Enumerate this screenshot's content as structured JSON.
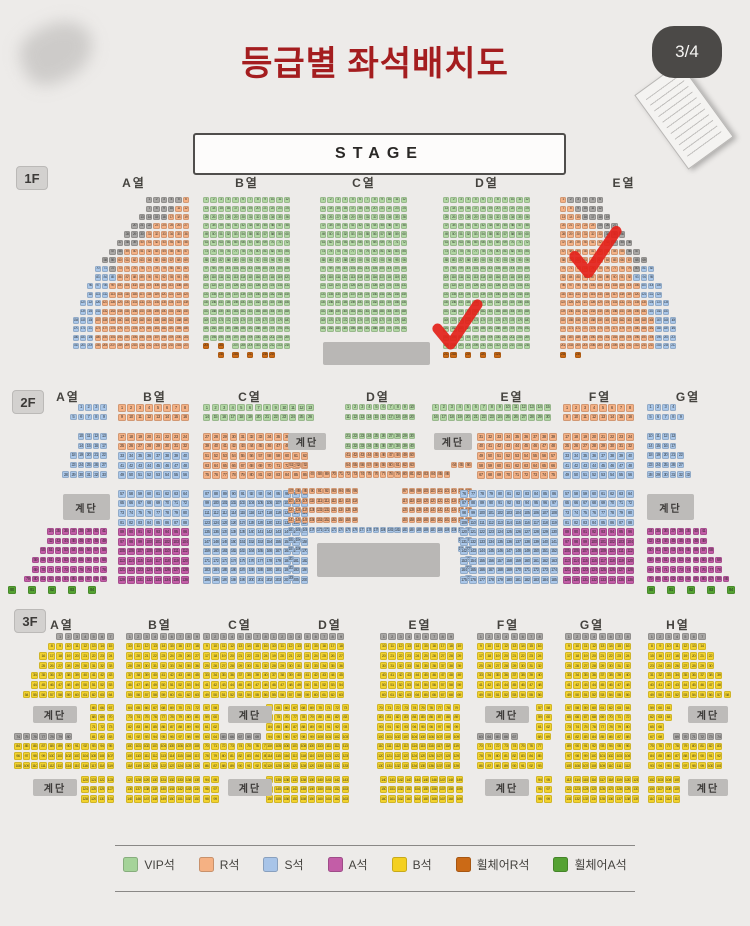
{
  "page": {
    "title": "등급별 좌석배치도",
    "page_indicator": "3/4"
  },
  "stage": {
    "label": "STAGE"
  },
  "stairs_label": "계단",
  "checkmark_color": "#e3221b",
  "seat_colors": {
    "G": "#b2d7a4",
    "R": "#f5b286",
    "S": "#aac7e9",
    "A": "#c35da7",
    "B": "#f3d32e",
    "W": "#cb6a16",
    "V": "#55a233",
    "X": "#a9a7a5"
  },
  "legend": {
    "items": [
      {
        "label": "VIP석",
        "color": "#a5d399"
      },
      {
        "label": "R석",
        "color": "#f5b183"
      },
      {
        "label": "S석",
        "color": "#a8c4e8"
      },
      {
        "label": "A석",
        "color": "#c35da7"
      },
      {
        "label": "B석",
        "color": "#f4d020"
      },
      {
        "label": "휠체어R석",
        "color": "#cb6a16"
      },
      {
        "label": "휠체어A석",
        "color": "#55a233"
      }
    ]
  },
  "floors": [
    {
      "id": "1F",
      "px": 7.35,
      "py": 8.6,
      "s": 6.3,
      "fs": 3.6,
      "badge": {
        "label": "1F",
        "x": 16,
        "y": 166
      },
      "labels": [
        {
          "text": "A열",
          "x": 134,
          "y": 174
        },
        {
          "text": "B열",
          "x": 247,
          "y": 174
        },
        {
          "text": "C열",
          "x": 364,
          "y": 174
        },
        {
          "text": "D열",
          "x": 487,
          "y": 174
        },
        {
          "text": "E열",
          "x": 624,
          "y": 174
        }
      ],
      "blocks": [
        {
          "section": "A",
          "x": 190,
          "y": 197,
          "align": "right",
          "rows": [
            "XXXXXR",
            "XXXXRR",
            "XXXXRRR",
            "XXXRRRRR",
            "XXXRRRRRR",
            "XXXRRRRRRR",
            "XXRRRRRRRRR",
            "XXRRRRRRRRRR",
            "SSXRRRRRRRRRR",
            "SSSRRRRRRRRRR",
            "SSSRRRRRRRRRRR",
            "SSSRRRRRRRRRRR",
            "SSSRRRRRRRRRRRR",
            "SSSRRRRRRRRRRRR",
            [
              4,
              "SSSRRRRRRRRRRRRR"
            ]
          ]
        },
        {
          "section": "B",
          "x": 203,
          "y": 197,
          "rows": [
            [
              17,
              "GGGGGGGGGGGG"
            ],
            "W.W.GGGGGGGG",
            "..W.W.W.WW"
          ]
        },
        {
          "section": "C",
          "x": 320,
          "y": 197,
          "rows": [
            [
              16,
              "GGGGGGGGGGGG"
            ]
          ]
        },
        {
          "section": "D",
          "x": 443,
          "y": 197,
          "rows": [
            [
              18,
              "GGGGGGGGGGGG"
            ],
            "WW.W.W.W"
          ]
        },
        {
          "section": "E",
          "x": 560,
          "y": 197,
          "rows": [
            "RXXXXX",
            "RRXXXX",
            "RRRXXXX",
            "RRRRRXXX",
            "RRRRRRXXX",
            "RRRRRRRXXX",
            "RRRRRRRRRXX",
            "RRRRRRRRRRXX",
            "RRRRRRRRRRXSS",
            "RRRRRRRRRRSSS",
            "RRRRRRRRRRRSSS",
            "RRRRRRRRRRRSSS",
            "RRRRRRRRRRRRSSS",
            "RRRRRRRRRRRRSSS",
            [
              4,
              "RRRRRRRRRRRRRSSS"
            ],
            "W.W"
          ]
        }
      ],
      "stairs": [],
      "consoles": [
        {
          "x": 323,
          "y": 342,
          "w": 107,
          "h": 23
        }
      ],
      "checks": [
        {
          "x": 428,
          "y": 298,
          "w": 58,
          "h": 52
        },
        {
          "x": 566,
          "y": 224,
          "w": 58,
          "h": 55
        }
      ]
    },
    {
      "id": "2F",
      "px": 9,
      "py": 9.6,
      "s": 7.7,
      "fs": 4.2,
      "badge": {
        "label": "2F",
        "x": 12,
        "y": 390
      },
      "labels": [
        {
          "text": "A열",
          "x": 68,
          "y": 388
        },
        {
          "text": "B열",
          "x": 155,
          "y": 388
        },
        {
          "text": "C열",
          "x": 250,
          "y": 388
        },
        {
          "text": "D열",
          "x": 378,
          "y": 388
        },
        {
          "text": "E열",
          "x": 512,
          "y": 388
        },
        {
          "text": "F열",
          "x": 600,
          "y": 388
        },
        {
          "text": "G열",
          "x": 688,
          "y": 388
        }
      ],
      "blocks": [
        {
          "section": "A",
          "x": 108,
          "y": 404,
          "align": "right",
          "px": 7.6,
          "s": 6.5,
          "rows": [
            "SSSS",
            "SSSSS"
          ]
        },
        {
          "section": "A",
          "x": 108,
          "y": 433,
          "align": "right",
          "px": 7.6,
          "s": 6.5,
          "rows": [
            "SSSS",
            "SSSS",
            "SSSSS",
            "SSSSS",
            "SSSSSS"
          ]
        },
        {
          "section": "A",
          "x": 108,
          "y": 528,
          "align": "right",
          "px": 7.6,
          "s": 6.5,
          "rows": [
            "AAAAAAAA",
            "AAAAAAAA",
            "AAAAAAAAA",
            "AAAAAAAAAA",
            "AAAAAAAAAA",
            "AAAAAAAAAAA"
          ]
        },
        {
          "section": "A",
          "x": 108,
          "y": 586,
          "align": "right",
          "px": 20,
          "rows": [
            "VVVVV"
          ]
        },
        {
          "section": "B",
          "x": 118,
          "y": 404,
          "rows": [
            [
              2,
              "RRRRRRRR"
            ]
          ]
        },
        {
          "section": "B",
          "x": 118,
          "y": 433,
          "rows": [
            "RRRRRRRR",
            "RRRRRRRR",
            "SSSSSSSS",
            "SSSSSSSS",
            "SSSSSSSS"
          ]
        },
        {
          "section": "B",
          "x": 118,
          "y": 490,
          "rows": [
            [
              4,
              "SSSSSSSS"
            ],
            [
              6,
              "AAAAAAAA"
            ]
          ]
        },
        {
          "section": "C",
          "x": 203,
          "y": 404,
          "px": 8.6,
          "s": 7.4,
          "rows": [
            [
              2,
              "GGGGGGGGGGGGG"
            ]
          ]
        },
        {
          "section": "C",
          "x": 203,
          "y": 433,
          "px": 8.9,
          "rows": [
            [
              5,
              "RRRRRRRRRRRR"
            ]
          ]
        },
        {
          "section": "C",
          "x": 203,
          "y": 490,
          "px": 8.9,
          "rows": [
            [
              10,
              "SSSSSSSSSSSS"
            ]
          ]
        },
        {
          "section": "D",
          "x": 288,
          "y": 404,
          "px": 7.1,
          "s": 6.2,
          "rows": [
            [
              2,
              "........GGGGGGGGGG........"
            ]
          ]
        },
        {
          "section": "D",
          "x": 288,
          "y": 433,
          "px": 7.1,
          "s": 6.2,
          "rows": [
            "........GGGGGGGGGG........",
            "........GGGGGGGGGG........",
            "........RRRRRRRRRR........",
            "RRR.....RRRRRRRRRR.....RRR",
            "...RRRRRRRRRRRRRRRRRRRR..."
          ]
        },
        {
          "section": "D",
          "x": 288,
          "y": 488,
          "px": 7.1,
          "s": 6.2,
          "rows": [
            [
              4,
              "RRRRRRRRRR......RRRRRRRRRR"
            ]
          ]
        },
        {
          "section": "D",
          "x": 288,
          "y": 527,
          "px": 7.1,
          "s": 6.2,
          "rows": [
            "SSSSSSSSSSSSSSSSSSSSSSSSSS",
            "SS......................SS",
            "SS......................SS",
            "S........................S",
            "S........................S",
            "S........................S"
          ]
        },
        {
          "section": "E",
          "x": 432,
          "y": 404,
          "px": 8,
          "s": 7,
          "rows": [
            [
              2,
              "GGGGGGGGGGGGGGG"
            ]
          ]
        },
        {
          "section": "E",
          "x": 477,
          "y": 433,
          "rows": [
            [
              5,
              "RRRRRRRRR"
            ]
          ]
        },
        {
          "section": "E",
          "x": 460,
          "y": 490,
          "rows": [
            [
              10,
              "SSSSSSSSSSS"
            ]
          ]
        },
        {
          "section": "F",
          "x": 563,
          "y": 404,
          "rows": [
            [
              2,
              "RRRRRRRR"
            ]
          ]
        },
        {
          "section": "F",
          "x": 563,
          "y": 433,
          "rows": [
            "RRRRRRRR",
            "RRRRRRRR",
            "SSSSSSSS",
            "SSSSSSSS",
            "SSSSSSSS"
          ]
        },
        {
          "section": "F",
          "x": 563,
          "y": 490,
          "rows": [
            [
              4,
              "SSSSSSSS"
            ],
            [
              6,
              "AAAAAAAA"
            ]
          ]
        },
        {
          "section": "G",
          "x": 647,
          "y": 404,
          "px": 7.6,
          "s": 6.5,
          "rows": [
            "SSSS",
            "SSSSS"
          ]
        },
        {
          "section": "G",
          "x": 647,
          "y": 433,
          "px": 7.6,
          "s": 6.5,
          "rows": [
            "SSSS",
            "SSSS",
            "SSSSS",
            "SSSSS",
            "SSSSSS"
          ]
        },
        {
          "section": "G",
          "x": 647,
          "y": 528,
          "px": 7.6,
          "s": 6.5,
          "rows": [
            "AAAAAAAA",
            "AAAAAAAA",
            "AAAAAAAAA",
            "AAAAAAAAAA",
            "AAAAAAAAAA",
            "AAAAAAAAAAA"
          ]
        },
        {
          "section": "G",
          "x": 647,
          "y": 586,
          "px": 20,
          "rows": [
            "VVVVV"
          ]
        }
      ],
      "stairs": [
        {
          "x": 63,
          "y": 494,
          "w": 47,
          "h": 26
        },
        {
          "x": 647,
          "y": 494,
          "w": 47,
          "h": 26
        },
        {
          "x": 288,
          "y": 433,
          "w": 38,
          "h": 17
        },
        {
          "x": 434,
          "y": 433,
          "w": 38,
          "h": 17
        }
      ],
      "consoles": [
        {
          "x": 317,
          "y": 543,
          "w": 123,
          "h": 34
        }
      ],
      "checks": []
    },
    {
      "id": "3F",
      "px": 8.4,
      "py": 9.7,
      "s": 7.2,
      "fs": 4,
      "badge": {
        "label": "3F",
        "x": 14,
        "y": 609
      },
      "labels": [
        {
          "text": "A열",
          "x": 62,
          "y": 616
        },
        {
          "text": "B열",
          "x": 160,
          "y": 616
        },
        {
          "text": "C열",
          "x": 240,
          "y": 616
        },
        {
          "text": "D열",
          "x": 330,
          "y": 616
        },
        {
          "text": "E열",
          "x": 420,
          "y": 616
        },
        {
          "text": "F열",
          "x": 508,
          "y": 616
        },
        {
          "text": "G열",
          "x": 592,
          "y": 616
        },
        {
          "text": "H열",
          "x": 678,
          "y": 616
        }
      ],
      "blocks": [
        {
          "section": "A",
          "x": 115,
          "y": 633,
          "align": "right",
          "rows": [
            "XXXXXXX",
            "BBBBBBBB",
            "BBBBBBBBB",
            "BBBBBBBBB",
            "BBBBBBBBBB",
            "BBBBBBBBBB",
            "BBBBBBBBBBB"
          ]
        },
        {
          "section": "A",
          "x": 115,
          "y": 704,
          "align": "right",
          "rows": [
            [
              3,
              "BBB"
            ]
          ]
        },
        {
          "section": "A",
          "x": 115,
          "y": 733,
          "align": "right",
          "rows": [
            "XXXXXXX..BBB",
            [
              3,
              "BBBBBBBBBBBB"
            ]
          ]
        },
        {
          "section": "A",
          "x": 115,
          "y": 776,
          "align": "right",
          "rows": [
            [
              3,
              "BBBB"
            ]
          ]
        },
        {
          "section": "B",
          "x": 126,
          "y": 633,
          "rows": [
            "XXXXXXXXX",
            [
              6,
              "BBBBBBBBB"
            ]
          ]
        },
        {
          "section": "B",
          "x": 126,
          "y": 704,
          "rows": [
            [
              7,
              "BBBBBBBBB"
            ]
          ]
        },
        {
          "section": "B",
          "x": 126,
          "y": 776,
          "rows": [
            [
              3,
              "BBBBBBBBB"
            ]
          ]
        },
        {
          "section": "C",
          "x": 203,
          "y": 633,
          "rows": [
            "XXXXXXXX",
            [
              6,
              "BBBBBBBB"
            ]
          ]
        },
        {
          "section": "C",
          "x": 203,
          "y": 704,
          "rows": [
            "BB",
            "BB",
            "BB",
            "BBXXXXX",
            [
              3,
              "BBBBBBBB"
            ]
          ]
        },
        {
          "section": "C",
          "x": 203,
          "y": 776,
          "rows": [
            [
              3,
              "BB"
            ]
          ]
        },
        {
          "section": "D",
          "x": 270,
          "y": 633,
          "rows": [
            "XXXXXXXXX",
            [
              6,
              "BBBBBBBBB"
            ]
          ]
        },
        {
          "section": "D",
          "x": 266,
          "y": 704,
          "rows": [
            [
              7,
              "BBBBBBBBBB"
            ]
          ]
        },
        {
          "section": "D",
          "x": 266,
          "y": 776,
          "rows": [
            [
              3,
              "BBBBBBBBBB"
            ]
          ]
        },
        {
          "section": "E",
          "x": 380,
          "y": 633,
          "rows": [
            "XXXXXXXXX",
            [
              6,
              "BBBBBBBBBB"
            ]
          ]
        },
        {
          "section": "E",
          "x": 377,
          "y": 704,
          "rows": [
            [
              7,
              "BBBBBBBBBB"
            ]
          ]
        },
        {
          "section": "E",
          "x": 380,
          "y": 776,
          "rows": [
            [
              3,
              "BBBBBBBBBB"
            ]
          ]
        },
        {
          "section": "F",
          "x": 477,
          "y": 633,
          "rows": [
            "XXXXXXXX",
            [
              6,
              "BBBBBBBB"
            ]
          ]
        },
        {
          "section": "F",
          "x": 536,
          "y": 704,
          "rows": [
            [
              3,
              "BB"
            ]
          ]
        },
        {
          "section": "F",
          "x": 477,
          "y": 733,
          "rows": [
            "XXXXX..BB",
            [
              3,
              "BBBBBBBB"
            ]
          ]
        },
        {
          "section": "F",
          "x": 536,
          "y": 776,
          "rows": [
            [
              3,
              "BB"
            ]
          ]
        },
        {
          "section": "G",
          "x": 565,
          "y": 633,
          "rows": [
            "XXXXXXXX",
            [
              6,
              "BBBBBBBB"
            ]
          ]
        },
        {
          "section": "G",
          "x": 565,
          "y": 704,
          "rows": [
            [
              7,
              "BBBBBBBB"
            ]
          ]
        },
        {
          "section": "G",
          "x": 565,
          "y": 776,
          "rows": [
            [
              3,
              "BBBBBBBBB"
            ]
          ]
        },
        {
          "section": "H",
          "x": 648,
          "y": 633,
          "rows": [
            "XXXXXXX",
            "BBBBBBB",
            "BBBBBBBB",
            "BBBBBBBB",
            "BBBBBBBBB",
            "BBBBBBBBB",
            "BBBBBBBBBB"
          ]
        },
        {
          "section": "H",
          "x": 648,
          "y": 704,
          "rows": [
            "BBB",
            "BBB",
            "BB",
            "BB.XXXXXX",
            [
              3,
              "BBBBBBBBB"
            ]
          ]
        },
        {
          "section": "H",
          "x": 648,
          "y": 776,
          "rows": [
            [
              3,
              "BBBB"
            ]
          ]
        }
      ],
      "stairs": [
        {
          "x": 33,
          "y": 706,
          "w": 44,
          "h": 17
        },
        {
          "x": 33,
          "y": 779,
          "w": 44,
          "h": 17
        },
        {
          "x": 228,
          "y": 706,
          "w": 44,
          "h": 17
        },
        {
          "x": 228,
          "y": 779,
          "w": 44,
          "h": 17
        },
        {
          "x": 485,
          "y": 706,
          "w": 44,
          "h": 17
        },
        {
          "x": 485,
          "y": 779,
          "w": 44,
          "h": 17
        },
        {
          "x": 688,
          "y": 706,
          "w": 40,
          "h": 17
        },
        {
          "x": 688,
          "y": 779,
          "w": 40,
          "h": 17
        }
      ],
      "consoles": [],
      "checks": []
    }
  ]
}
